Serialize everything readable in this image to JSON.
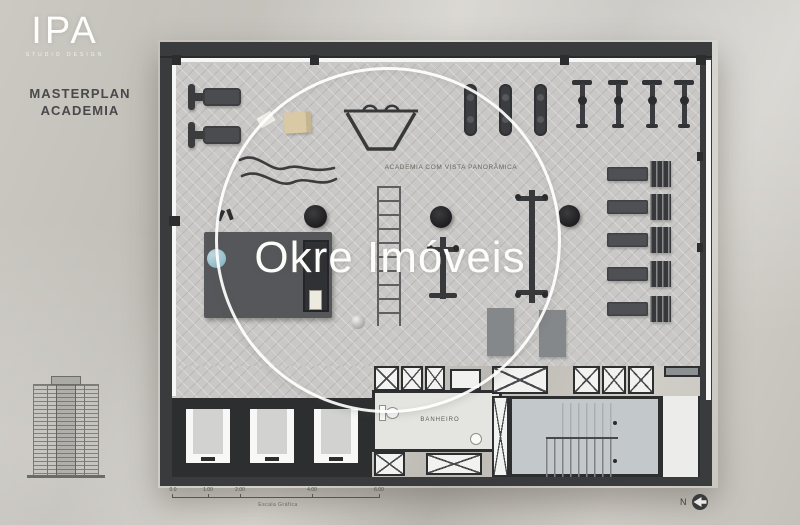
{
  "branding": {
    "logo_text": "IPA",
    "logo_subtext": "STUDIO DESIGN",
    "plan_title_line1": "MASTERPLAN",
    "plan_title_line2": "ACADEMIA"
  },
  "watermark": {
    "brand": "Okre Imóveis"
  },
  "floor_plan": {
    "gym_label": "ACADEMIA COM VISTA PANORÂMICA",
    "bathroom_label": "BANHEIRO",
    "equipment_icons": [
      "treadmill-icon",
      "battle-ropes-icon",
      "trap-bar-rig-icon",
      "agility-ladder-icon",
      "elliptical-icon",
      "spin-bike-icon",
      "weight-bench-icon",
      "exercise-mat-icon",
      "stability-ball-icon",
      "cable-machine-icon",
      "punching-bag-icon",
      "medicine-ball-icon",
      "floor-mat-icon",
      "elevator-icon",
      "shaft-x-icon",
      "stairs-icon",
      "toilet-icon",
      "sink-icon",
      "tower-elevation-icon",
      "north-arrow-icon"
    ]
  },
  "scale_bar": {
    "tick_labels": [
      "0.0",
      "1.00",
      "2.00",
      "4.00",
      "6.00"
    ],
    "caption": "Escala Gráfica"
  },
  "compass": {
    "label": "N"
  },
  "colors": {
    "background": "#c6c3bd",
    "wall": "#3a3b3d",
    "floor": "#c9c8c6",
    "equipment_dark": "#3f4043",
    "accent_ball_blue": "#9cc5d1",
    "beige_box": "#d9c9a5",
    "stair_floor": "#c3c8cb",
    "watermark_white": "#ffffff"
  }
}
